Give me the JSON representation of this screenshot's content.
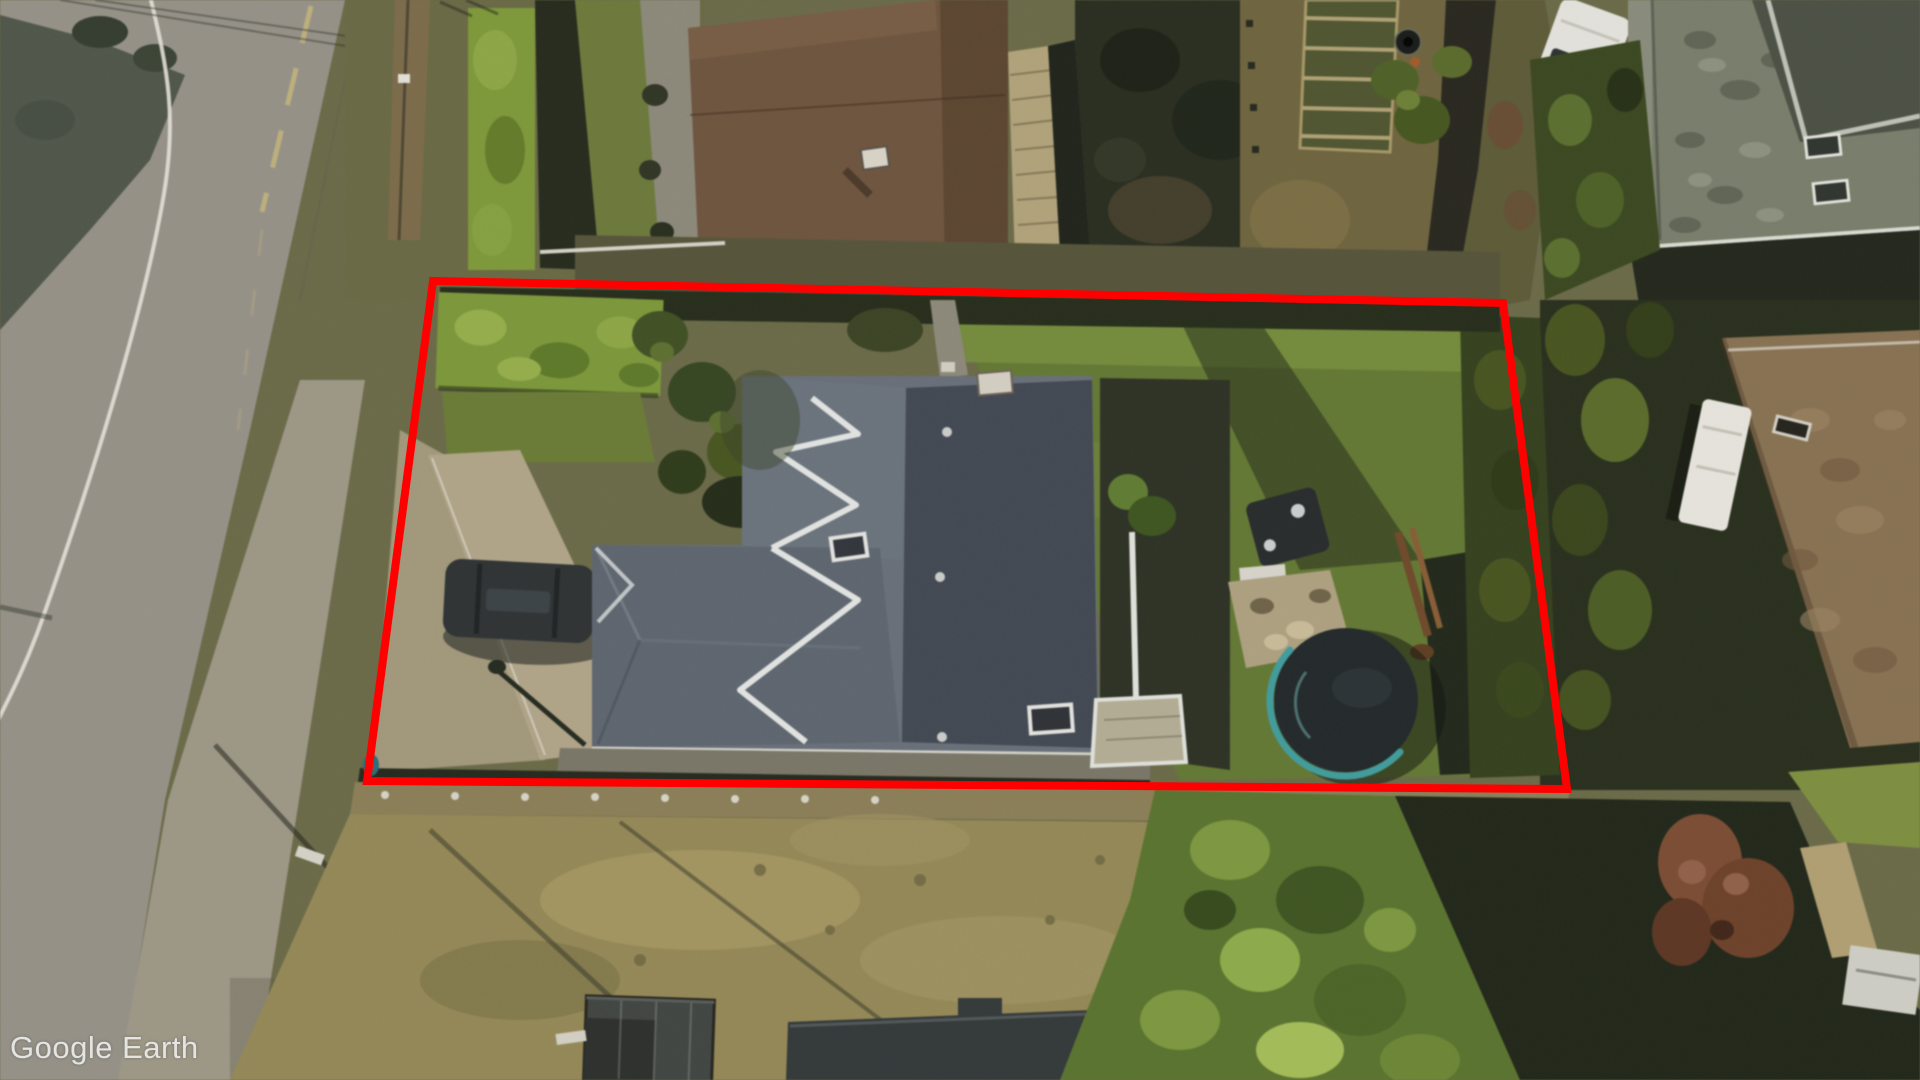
{
  "app": {
    "name": "Google Earth"
  },
  "watermark": {
    "text": "Google Earth",
    "color": "#e9e9e7"
  },
  "annotation": {
    "type": "property-boundary-outline",
    "points": "433,281 1503,303 1567,789 367,781",
    "stroke_color": "#ff0000",
    "stroke_width": 8
  },
  "scene": {
    "view": "aerial-satellite",
    "features": [
      "curved road with white edge line and yellow center line on left",
      "residential property outlined in red",
      "large house with dark blue-gray roof, white ridge caps and two skylights",
      "bright green hedge and lawn inside north-west corner of lot",
      "concrete driveway with dark parked SUV",
      "backyard lawn with trampoline with teal rim, boat trailer and gravel patio",
      "neighboring house with brown roof and corrugated shed to the north",
      "garden beds, compost barrel and white van at top right",
      "large gray-roofed neighbor house in top right corner",
      "brown hip-roof neighbor house with white RV on the right",
      "open tan field with two dark sheds at the bottom",
      "dense green hedge mass and russet tree at bottom right"
    ]
  }
}
